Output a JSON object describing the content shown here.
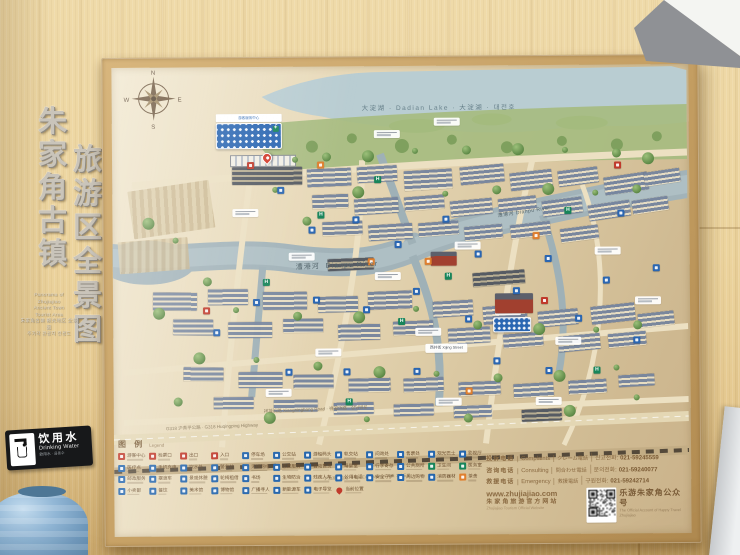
{
  "scene": {
    "title1": "朱家角古镇",
    "title2": "旅游区全景图",
    "subtitle_lines": [
      "Panorama of",
      "Zhujiajiao",
      "Ancient Town",
      "Tourist Area",
      "朱家角古鎮 観光地区 全景図",
      "주가각 관광지 전경도"
    ]
  },
  "drinking_water": {
    "zh": "饮用水",
    "en": "Drinking Water",
    "sub": "飲用水 · 음용수"
  },
  "map": {
    "compass": {
      "n": "N",
      "e": "E",
      "s": "S",
      "w": "W"
    },
    "lake_label": "大淀湖 · Dadian Lake · 大淀湖 · 대전호",
    "river_zh": "漕港河",
    "river_en": "Dianpu River",
    "street_label": "西井街 Xijing Street",
    "xiangningbang": "祥凝浜路 Xiangningbang Road · 祥凝浜路 · 샹닝방로",
    "highway": "G318 沪青平公路 · G318 Huqingping Highway",
    "expressway": "沪渝高速公路 · Huyu Expressway · 후위 고속도로",
    "visitor_center": "游客服务中心"
  },
  "legend": {
    "title_zh": "图 例",
    "title_en": "Legend",
    "rows": [
      [
        {
          "c": "r",
          "t": "游客中心"
        },
        {
          "c": "r",
          "t": "检票口"
        },
        {
          "c": "r",
          "t": "出口"
        },
        {
          "c": "r",
          "t": "入口"
        },
        {
          "c": "b",
          "t": "停车场"
        },
        {
          "c": "b",
          "t": "公交站"
        },
        {
          "c": "b",
          "t": "游船码头"
        },
        {
          "c": "b",
          "t": "轨交站"
        },
        {
          "c": "b",
          "t": "问询处"
        },
        {
          "c": "b",
          "t": "售票处"
        },
        {
          "c": "b",
          "t": "观光巴士"
        },
        {
          "c": "b",
          "t": "影视厅"
        }
      ],
      [
        {
          "c": "b",
          "t": "医疗点"
        },
        {
          "c": "b",
          "t": "手机充电"
        },
        {
          "c": "b",
          "t": "饮水处"
        },
        {
          "c": "b",
          "t": "警务站"
        },
        {
          "c": "b",
          "t": "无线网络"
        },
        {
          "c": "b",
          "t": "志愿服务"
        },
        {
          "c": "b",
          "t": "自动售货"
        },
        {
          "c": "b",
          "t": "母婴室"
        },
        {
          "c": "b",
          "t": "行李寄存"
        },
        {
          "c": "b",
          "t": "公共厕所"
        },
        {
          "c": "g",
          "t": "卫生间"
        },
        {
          "c": "g",
          "t": "医务室"
        }
      ],
      [
        {
          "c": "b",
          "t": "邮政服务"
        },
        {
          "c": "b",
          "t": "摆渡车"
        },
        {
          "c": "b",
          "t": "景观休憩"
        },
        {
          "c": "b",
          "t": "轮椅租借"
        },
        {
          "c": "b",
          "t": "书场"
        },
        {
          "c": "b",
          "t": "生物防治"
        },
        {
          "c": "b",
          "t": "残疾人车"
        },
        {
          "c": "b",
          "t": "公用电话"
        },
        {
          "c": "b",
          "t": "安全守护"
        },
        {
          "c": "b",
          "t": "周边购物"
        },
        {
          "c": "b",
          "t": "消防器材"
        },
        {
          "c": "o",
          "t": "茶舍"
        }
      ],
      [
        {
          "c": "b",
          "t": "小卖部"
        },
        {
          "c": "b",
          "t": "餐饮"
        },
        {
          "c": "b",
          "t": "美术馆"
        },
        {
          "c": "b",
          "t": "博物馆"
        },
        {
          "c": "b",
          "t": "广播寻人"
        },
        {
          "c": "b",
          "t": "新能源车"
        },
        {
          "c": "b",
          "t": "电子导览"
        },
        {
          "c": "rp",
          "t": "当前位置"
        }
      ]
    ]
  },
  "contacts": {
    "rows": [
      {
        "zh": "投诉电话",
        "en": "Complaints",
        "ja": "クレーム電話",
        "ko": "신고전화",
        "phone": "021-59245559"
      },
      {
        "zh": "咨询电话",
        "en": "Consulting",
        "ja": "問合わせ電話",
        "ko": "문의전화",
        "phone": "021-59240077"
      },
      {
        "zh": "救援电话",
        "en": "Emergency",
        "ja": "救援電話",
        "ko": "구원전화",
        "phone": "021-59242714"
      }
    ]
  },
  "footer": {
    "url": "www.zhujiajiao.com",
    "site_zh": "朱家角旅游官方网站",
    "site_en": "Zhujiajiao Tourism Official Website",
    "qr_zh": "乐游朱家角公众号",
    "qr_en": "The Official Account of Happy Travel Zhujiajiao"
  }
}
